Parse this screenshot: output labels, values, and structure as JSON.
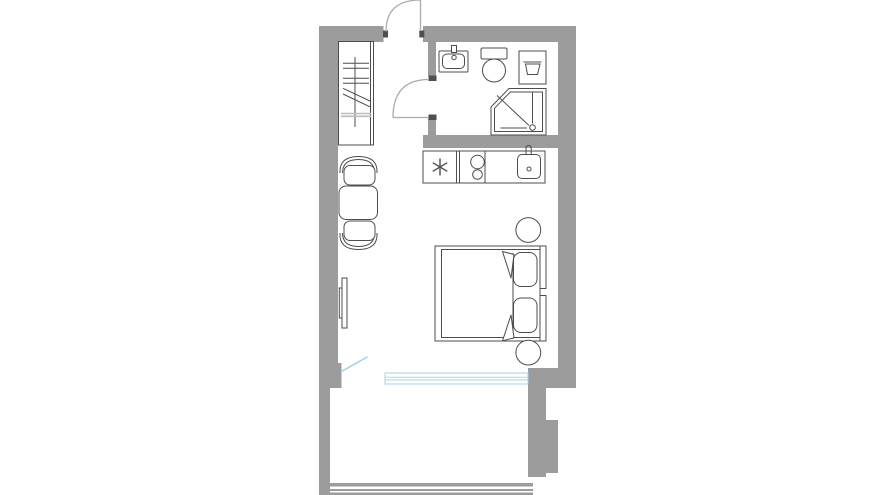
{
  "title": "",
  "colors": {
    "wall": "#9c9c9c",
    "jamb": "#4f4f4f",
    "line": "#4d4d4d",
    "door": "#ababab",
    "faint": "#bdbdbd",
    "blue": "#a8d2ea",
    "bg": "#ffffff"
  },
  "fixtures": [
    "entry-door",
    "wardrobe",
    "bathroom-door",
    "bathroom-sink",
    "toilet",
    "washing-machine",
    "shower",
    "kitchen-counter",
    "freezer-symbol",
    "hob-burners",
    "kitchen-sink",
    "dining-table",
    "dining-chair-top",
    "dining-chair-bottom",
    "wall-tv",
    "double-bed",
    "pillow",
    "pillow",
    "nightstand",
    "nightstand",
    "balcony-door-swing",
    "window-band",
    "balcony-railing"
  ]
}
